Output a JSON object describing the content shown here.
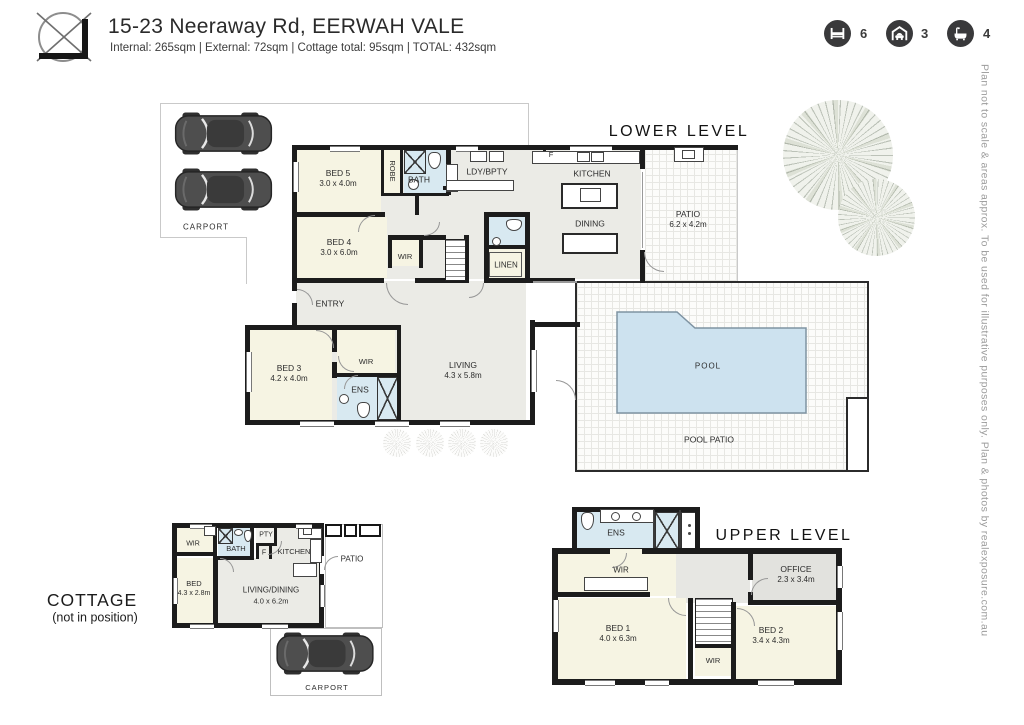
{
  "header": {
    "title": "15-23 Neeraway Rd, EERWAH VALE",
    "subtitle": "Internal: 265sqm  |  External: 72sqm  |  Cottage total: 95sqm  |  TOTAL: 432sqm"
  },
  "stats": {
    "beds": {
      "icon": "bed-icon",
      "value": "6"
    },
    "garages": {
      "icon": "garage-icon",
      "value": "3"
    },
    "baths": {
      "icon": "bath-icon",
      "value": "4"
    }
  },
  "side_note": "Plan not to scale & areas approx. To be used for illustrative purposes only. Plan & photos by realexposure.com.au",
  "lower_level": {
    "title": "LOWER LEVEL",
    "carport_label": "CARPORT",
    "rooms": {
      "bed5": {
        "name": "BED 5",
        "dims": "3.0 x 4.0m"
      },
      "robe": {
        "name": "ROBE"
      },
      "bath": {
        "name": "BATH"
      },
      "ldy": {
        "name": "LDY/BPTY"
      },
      "fridge": {
        "name": "F"
      },
      "kitchen": {
        "name": "KITCHEN"
      },
      "dining": {
        "name": "DINING"
      },
      "patio": {
        "name": "PATIO",
        "dims": "6.2 x 4.2m"
      },
      "bed4": {
        "name": "BED 4",
        "dims": "3.0 x 6.0m"
      },
      "wir_bed4": {
        "name": "WIR"
      },
      "linen": {
        "name": "LINEN"
      },
      "entry": {
        "name": "ENTRY"
      },
      "bed3": {
        "name": "BED 3",
        "dims": "4.2 x 4.0m"
      },
      "wir_bed3": {
        "name": "WIR"
      },
      "ens": {
        "name": "ENS"
      },
      "living": {
        "name": "LIVING",
        "dims": "4.3 x 5.8m"
      },
      "pool": {
        "name": "POOL"
      },
      "pool_patio": {
        "name": "POOL PATIO"
      }
    }
  },
  "upper_level": {
    "title": "UPPER LEVEL",
    "rooms": {
      "ens": {
        "name": "ENS"
      },
      "wir_top": {
        "name": "WIR"
      },
      "office": {
        "name": "OFFICE",
        "dims": "2.3 x 3.4m"
      },
      "bed1": {
        "name": "BED 1",
        "dims": "4.0 x 6.3m"
      },
      "bed2": {
        "name": "BED 2",
        "dims": "3.4 x 4.3m"
      },
      "wir_mid": {
        "name": "WIR"
      }
    }
  },
  "cottage": {
    "title": "COTTAGE",
    "subtitle": "(not in position)",
    "carport_label": "CARPORT",
    "rooms": {
      "wir": {
        "name": "WIR"
      },
      "bath": {
        "name": "BATH"
      },
      "pty": {
        "name": "PTY"
      },
      "fridge": {
        "name": "F"
      },
      "kitchen": {
        "name": "KITCHEN"
      },
      "bed": {
        "name": "BED",
        "dims": "4.3 x 2.8m"
      },
      "living": {
        "name": "LIVING/DINING",
        "dims": "4.0 x 6.2m"
      },
      "patio": {
        "name": "PATIO"
      }
    }
  },
  "colors": {
    "wall": "#1c1c1c",
    "room_cream": "#f6f4e3",
    "room_gray": "#ebebe6",
    "wet_area_blue": "#d8e9f1",
    "pool_fill": "#cde2ef",
    "stat_circle": "#39393b"
  }
}
